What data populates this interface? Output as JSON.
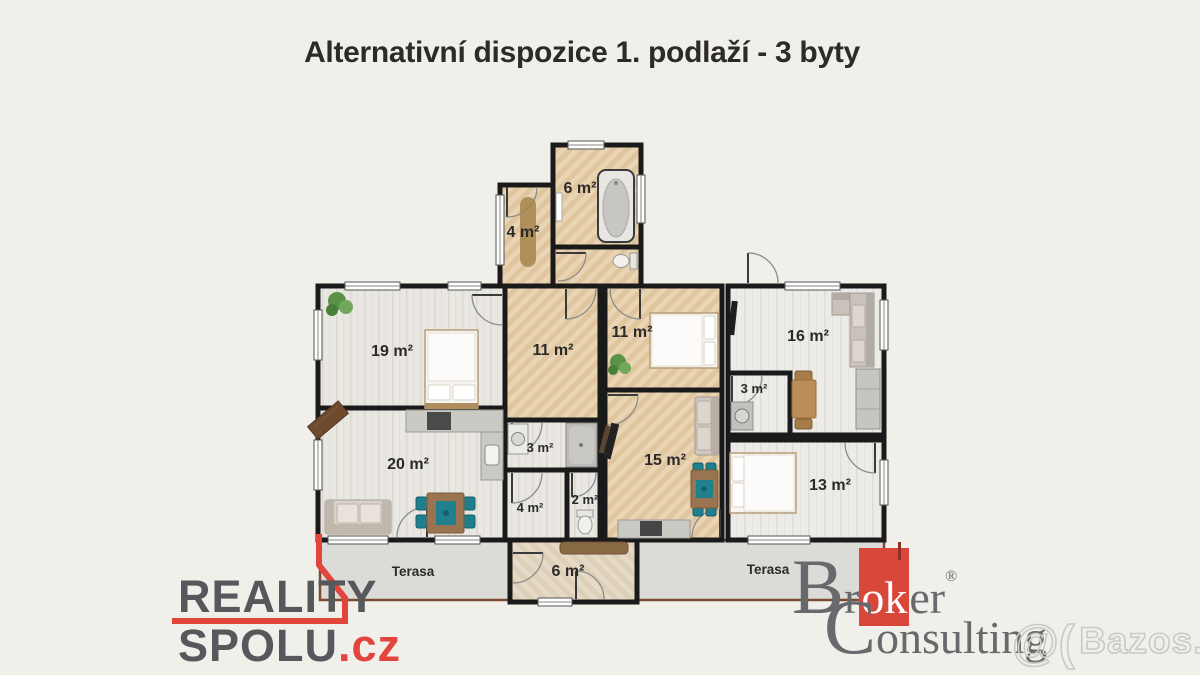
{
  "title": "Alternativní dispozice 1. podlaží - 3  byty",
  "plan": {
    "rooms": {
      "bath_top": "6 m²",
      "hall_top": "4 m²",
      "bedroom_19": "19 m²",
      "hall_center": "11 m²",
      "bedroom_11": "11 m²",
      "living_16": "16 m²",
      "storage_3_right": "3 m²",
      "living_20": "20 m²",
      "bath_3_left": "3 m²",
      "wc_2": "2 m²",
      "living_15": "15 m²",
      "bedroom_13": "13 m²",
      "hall_4_bottom": "4 m²",
      "entry_6_bottom": "6 m²",
      "terrace_left": "Terasa",
      "terrace_right": "Terasa"
    }
  },
  "branding": {
    "reality_spolu": {
      "line1": "REALITY",
      "line2": "SPOLU",
      "tld": ".cz"
    },
    "broker_consulting": {
      "word1_initial": "B",
      "word1_pre": "r",
      "word1_red": "ok",
      "word1_post": "er",
      "registered": "®",
      "word2_initial": "C",
      "word2_rest": "onsulting"
    },
    "watermark": {
      "mark": "@(",
      "site": "Bazos.cz"
    }
  },
  "colors": {
    "background": "#f0efea",
    "title_text": "#2d2a2a",
    "accent_red": "#e2453c",
    "broker_red": "#d8473a",
    "logo_gray": "#57585b",
    "wall": "#1a1a1a",
    "terrace_border": "#7b4b33",
    "terrace_fill": "#dbdbd8",
    "parquet": "#e9d5b6",
    "plank_light": "#e9e7e1",
    "teal_furniture": "#20808d"
  }
}
